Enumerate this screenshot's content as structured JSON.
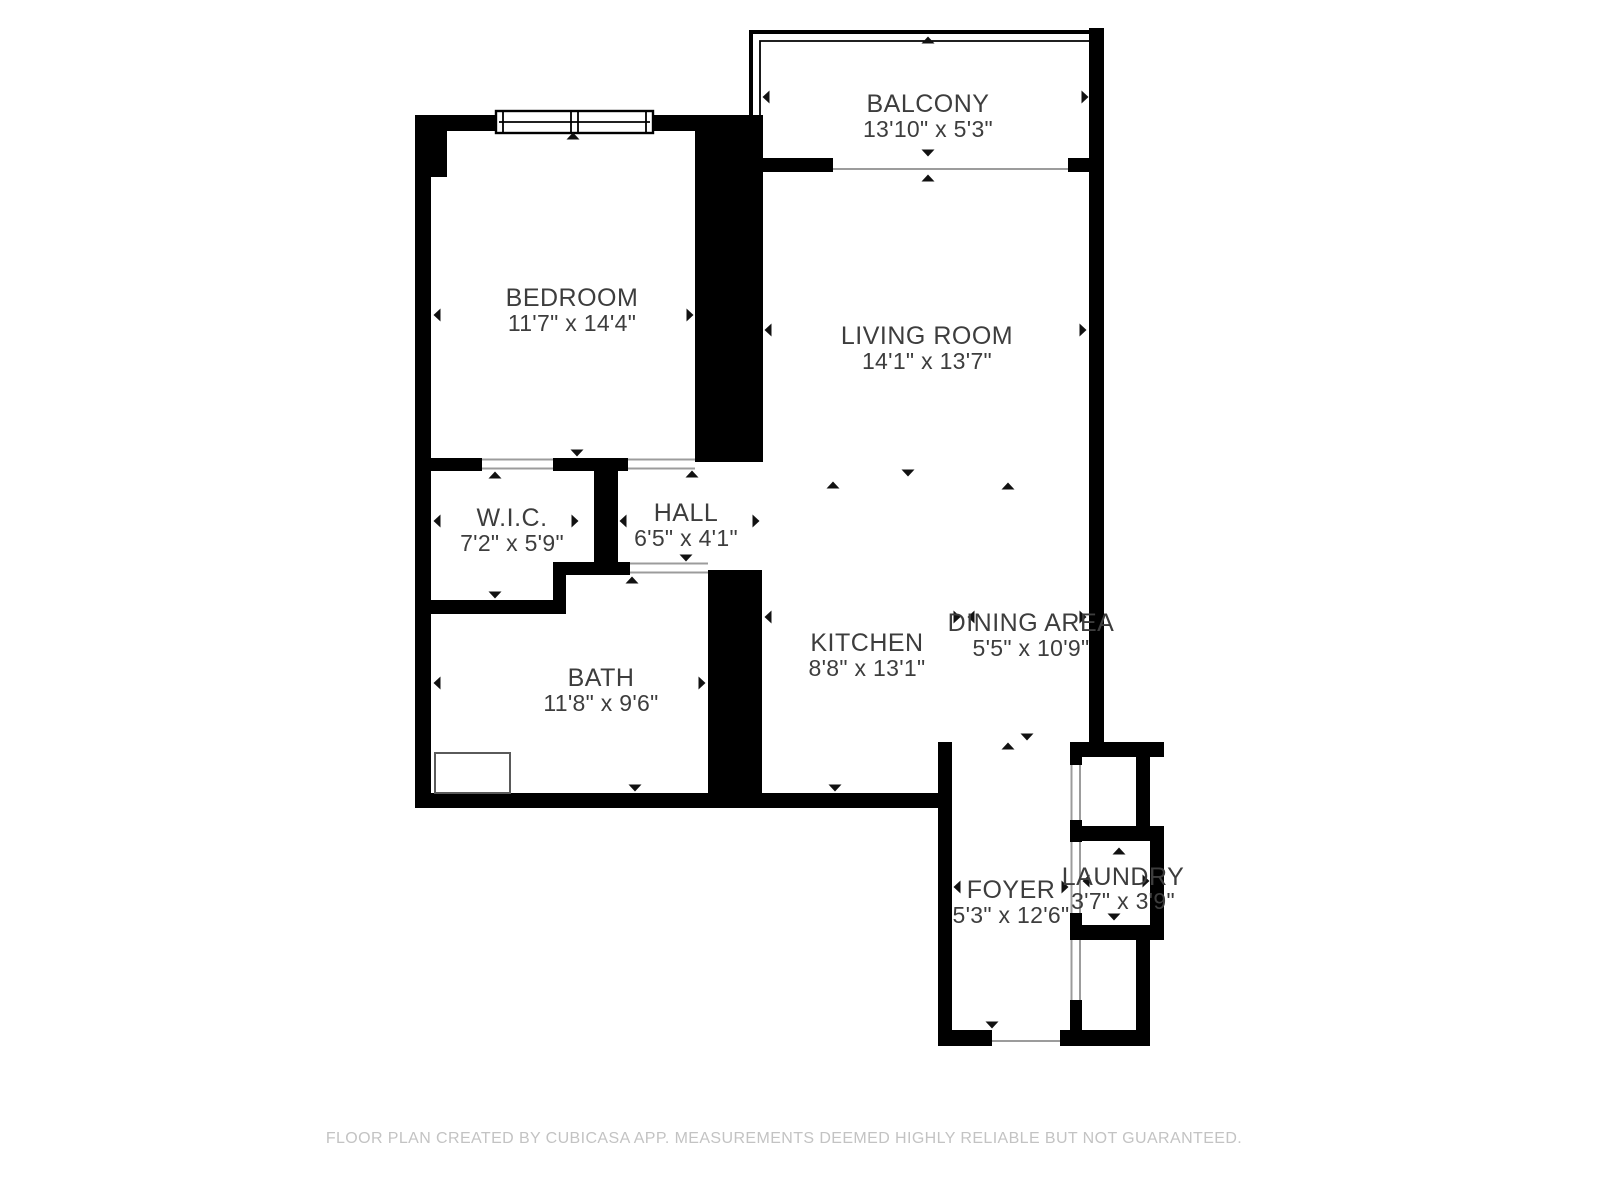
{
  "plan": {
    "title": "Floor plan",
    "rooms": [
      {
        "id": "balcony",
        "name": "BALCONY",
        "dims": "13'10\" x 5'3\""
      },
      {
        "id": "bedroom",
        "name": "BEDROOM",
        "dims": "11'7\" x 14'4\""
      },
      {
        "id": "living-room",
        "name": "LIVING ROOM",
        "dims": "14'1\" x 13'7\""
      },
      {
        "id": "wic",
        "name": "W.I.C.",
        "dims": "7'2\" x 5'9\""
      },
      {
        "id": "hall",
        "name": "HALL",
        "dims": "6'5\" x 4'1\""
      },
      {
        "id": "bath",
        "name": "BATH",
        "dims": "11'8\" x 9'6\""
      },
      {
        "id": "kitchen",
        "name": "KITCHEN",
        "dims": "8'8\" x 13'1\""
      },
      {
        "id": "dining-area",
        "name": "DINING AREA",
        "dims": "5'5\" x 10'9\""
      },
      {
        "id": "foyer",
        "name": "FOYER",
        "dims": "5'3\" x 12'6\""
      },
      {
        "id": "laundry",
        "name": "LAUNDRY",
        "dims": "3'7\" x 3'9\""
      }
    ],
    "footer": "FLOOR PLAN CREATED BY CUBICASA APP. MEASUREMENTS DEEMED HIGHLY RELIABLE BUT NOT GUARANTEED.",
    "colors": {
      "wall": "#000000",
      "label": "#3d3d3d",
      "opening_line": "#9c9c9c",
      "footer": "#c3c3c3",
      "background": "#ffffff"
    }
  }
}
